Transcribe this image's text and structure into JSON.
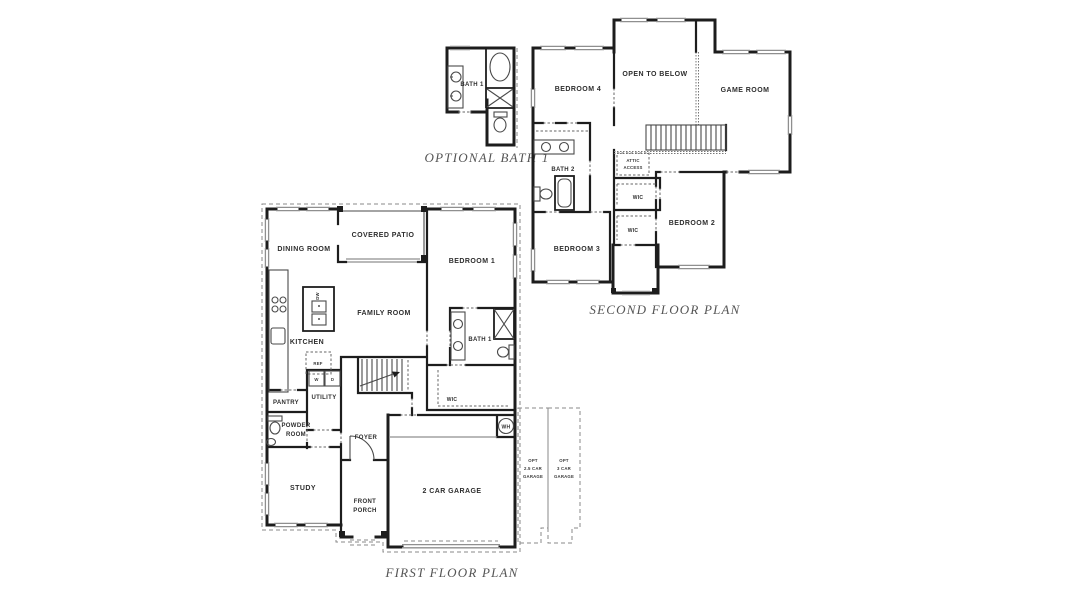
{
  "meta": {
    "description": "Two-story house floor plan drawing",
    "background_color": "#ffffff",
    "wall_color": "#1d1d1d",
    "window_color": "#8f8f8f",
    "dashed_line_color": "#8a8a8a",
    "room_label_color": "#2e2e2e",
    "title_color": "#555555"
  },
  "optional_bath_detail": {
    "title": "OPTIONAL BATH 1",
    "labels": {
      "bath": "BATH 1"
    }
  },
  "second_floor": {
    "title": "SECOND FLOOR PLAN",
    "labels": {
      "bedroom4": "BEDROOM 4",
      "open_to_below": "OPEN TO BELOW",
      "game_room": "GAME ROOM",
      "bath2": "BATH 2",
      "attic_line1": "ATTIC",
      "attic_line2": "ACCESS",
      "wic_upper": "WIC",
      "wic_lower": "WIC",
      "bedroom2": "BEDROOM 2",
      "bedroom3": "BEDROOM 3"
    }
  },
  "first_floor": {
    "title": "FIRST FLOOR PLAN",
    "labels": {
      "dining_room": "DINING ROOM",
      "covered_patio": "COVERED PATIO",
      "bedroom1": "BEDROOM 1",
      "family_room": "FAMILY ROOM",
      "kitchen": "KITCHEN",
      "pantry": "PANTRY",
      "utility": "UTILITY",
      "powder_line1": "POWDER",
      "powder_line2": "ROOM",
      "foyer": "FOYER",
      "study": "STUDY",
      "front_porch_line1": "FRONT",
      "front_porch_line2": "PORCH",
      "bath1": "BATH 1",
      "wic": "WIC",
      "garage": "2 CAR GARAGE"
    },
    "fixtures": {
      "water_heater": "WH",
      "refrigerator": "REF",
      "dishwasher": "DW",
      "washer": "W",
      "dryer": "D"
    },
    "options": {
      "opt25_line1": "OPT",
      "opt25_line2": "2.5 CAR",
      "opt25_line3": "GARAGE",
      "opt3_line1": "OPT",
      "opt3_line2": "3 CAR",
      "opt3_line3": "GARAGE"
    }
  }
}
